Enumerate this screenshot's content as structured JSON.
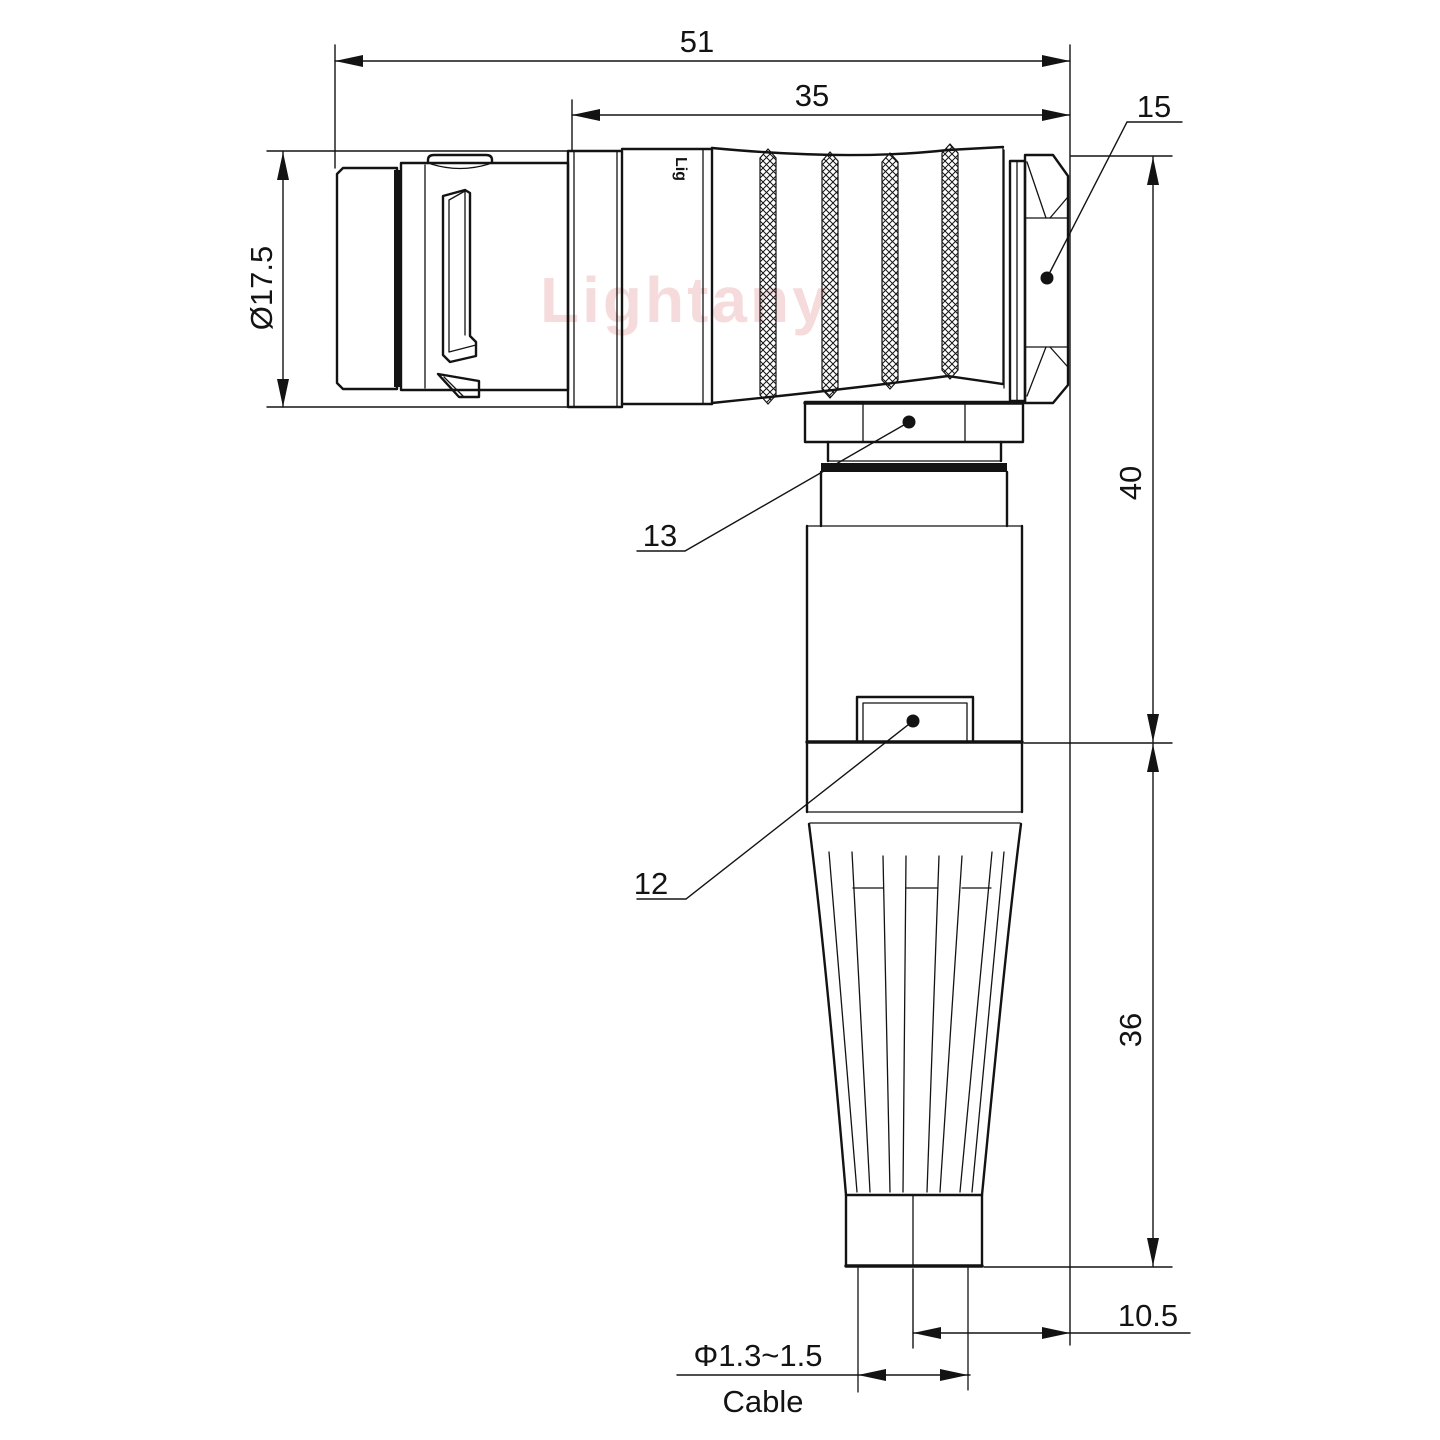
{
  "drawing": {
    "watermark": "Lightany",
    "body_engraving": "Lig",
    "dims": {
      "overall_length": "51",
      "knurl_length": "35",
      "backnut_ref": "15",
      "front_od": "Ø17.5",
      "elbow_height": "40",
      "boot_height": "36",
      "cable_offset": "10.5",
      "cable_od": "Φ1.3~1.5",
      "cable_label": "Cable",
      "ref_collar": "13",
      "ref_latch": "12"
    },
    "colors": {
      "line": "#131313",
      "watermark": "#e08c8c",
      "background": "#ffffff"
    }
  }
}
